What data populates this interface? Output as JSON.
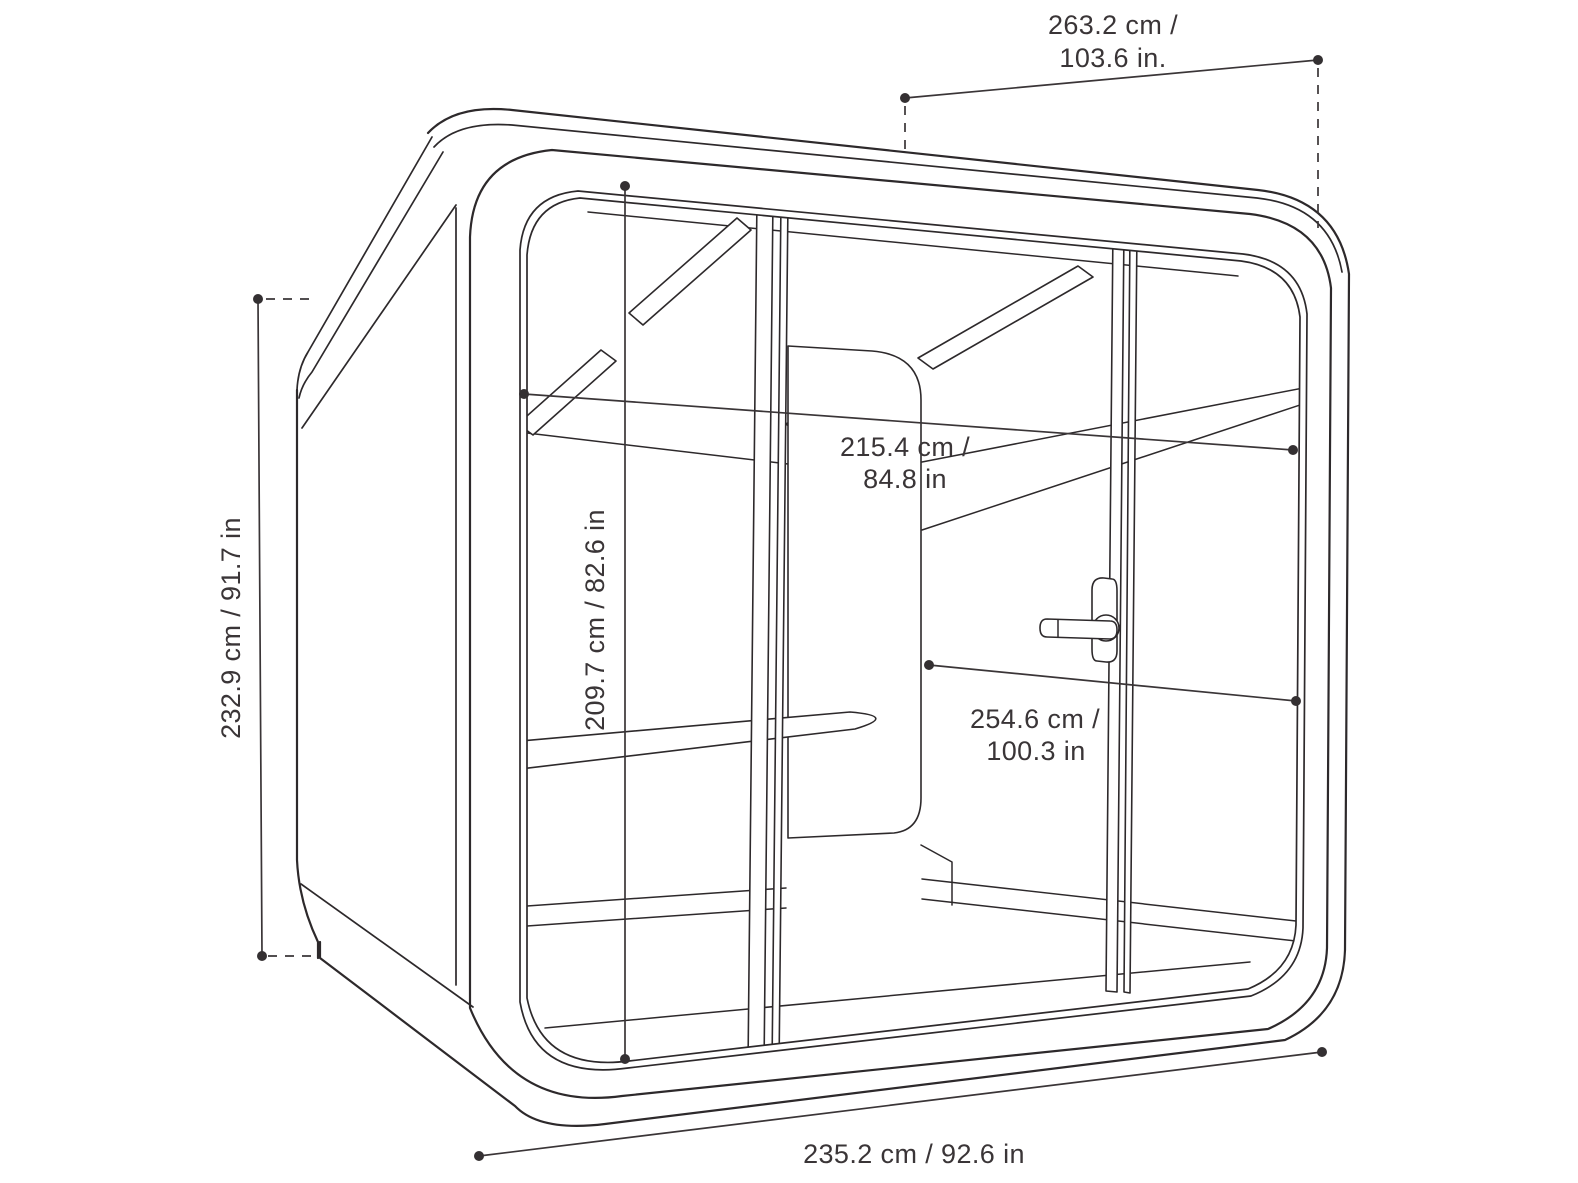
{
  "page": {
    "background": "#ffffff",
    "title": "Meeting pod dimension diagram"
  },
  "diagram": {
    "subject": "glass-front office meeting pod, perspective technical line drawing",
    "line_color": "#2d292b",
    "text_color": "#3a3537",
    "dimensions": {
      "depth_top": {
        "line1": "263.2 cm /",
        "line2": "103.6 in."
      },
      "height_exterior": {
        "label": "232.9 cm / 91.7 in"
      },
      "width_interior": {
        "line1": "215.4 cm /",
        "line2": "84.8 in"
      },
      "height_interior": {
        "label": "209.7 cm / 82.6 in"
      },
      "diagonal_interior": {
        "line1": "254.6 cm /",
        "line2": "100.3 in"
      },
      "width_exterior": {
        "label": "235.2 cm / 92.6 in"
      }
    }
  }
}
